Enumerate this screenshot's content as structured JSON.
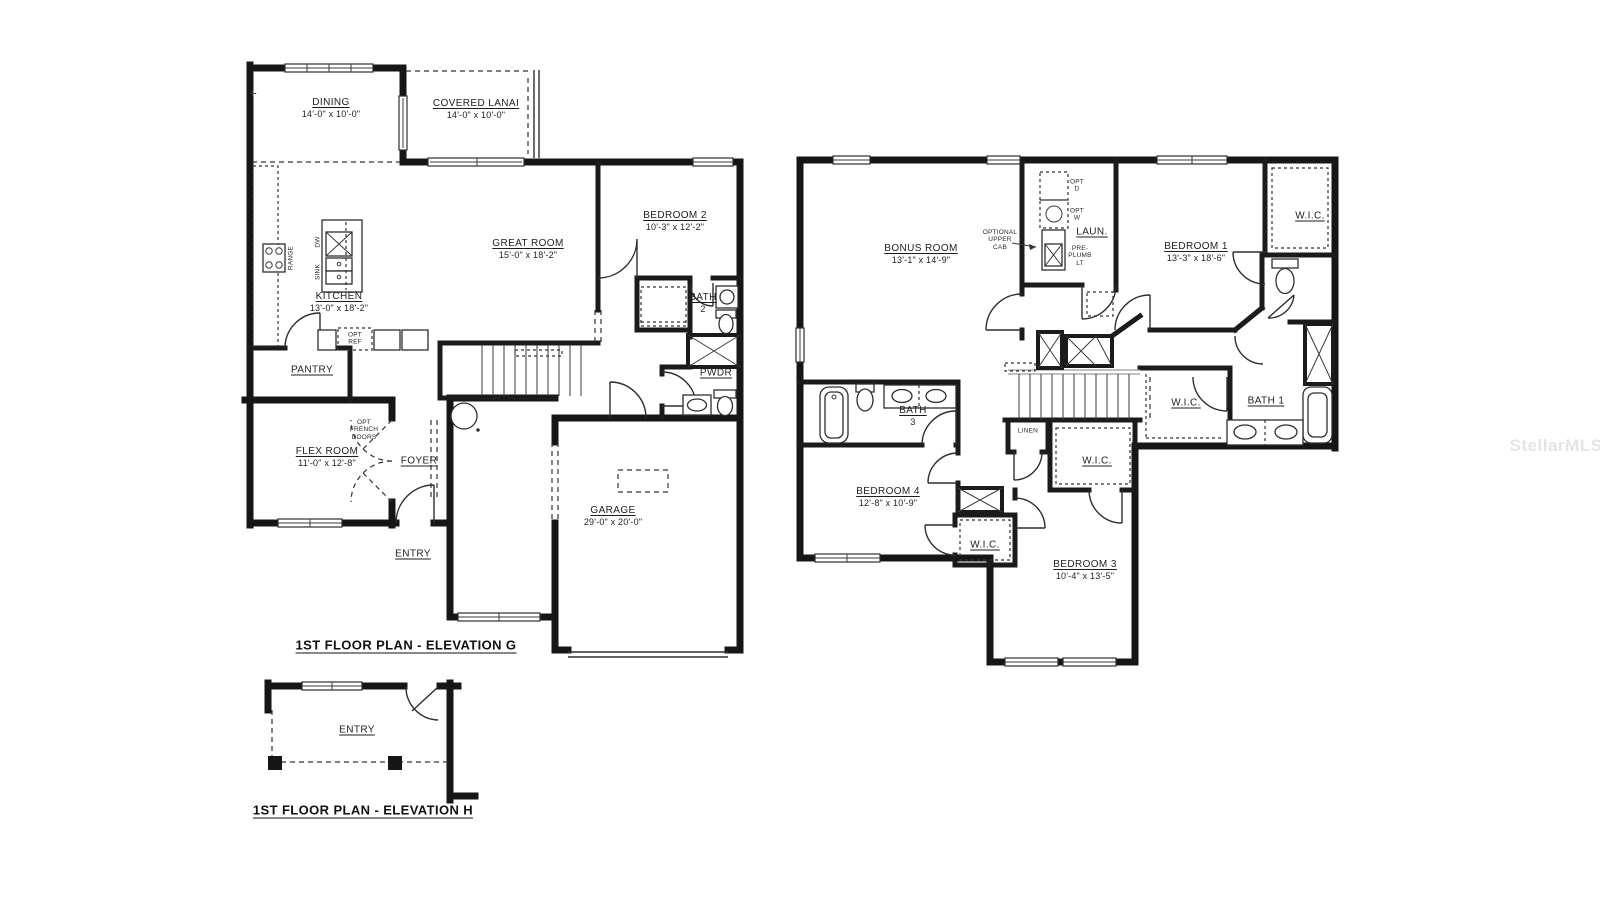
{
  "type": "floor-plan",
  "watermark": "StellarMLS",
  "corner_mark": "+",
  "plans": [
    {
      "name": "first-floor-elevation-g",
      "caption": "1ST FLOOR PLAN - ELEVATION G",
      "rooms": [
        {
          "label": "DINING",
          "dims": "14'-0\" x 10'-0\"",
          "x": 331,
          "y": 108
        },
        {
          "label": "COVERED LANAI",
          "dims": "14'-0\" x 10'-0\"",
          "x": 476,
          "y": 109
        },
        {
          "label": "GREAT ROOM",
          "dims": "15'-0\" x 18'-2\"",
          "x": 528,
          "y": 249
        },
        {
          "label": "BEDROOM 2",
          "dims": "10'-3\" x 12'-2\"",
          "x": 675,
          "y": 221
        },
        {
          "label": "KITCHEN",
          "dims": "13'-0\" x 18'-2\"",
          "x": 339,
          "y": 302
        },
        {
          "label": "BATH",
          "dims": "2",
          "x": 703,
          "y": 303
        },
        {
          "label": "PANTRY",
          "x": 312,
          "y": 370
        },
        {
          "label": "PWDR",
          "x": 716,
          "y": 373
        },
        {
          "label": "FLEX ROOM",
          "dims": "11'-0\" x 12'-8\"",
          "x": 327,
          "y": 457
        },
        {
          "label": "FOYER",
          "x": 419,
          "y": 461
        },
        {
          "label": "ENTRY",
          "x": 413,
          "y": 554
        },
        {
          "label": "GARAGE",
          "dims": "29'-0\" x 20'-0\"",
          "x": 613,
          "y": 516
        }
      ],
      "annotations": [
        {
          "text": "OPT\nFRENCH\nDOORS",
          "x": 364,
          "y": 430
        },
        {
          "text": "OPT\nREF",
          "x": 355,
          "y": 339
        },
        {
          "text": "RANGE",
          "x": 291,
          "y": 258,
          "rotate": -90
        },
        {
          "text": "DW",
          "x": 318,
          "y": 242,
          "rotate": -90
        },
        {
          "text": "SINK",
          "x": 318,
          "y": 272,
          "rotate": -90
        }
      ]
    },
    {
      "name": "second-floor",
      "caption": "",
      "rooms": [
        {
          "label": "BONUS ROOM",
          "dims": "13'-1\" x 14'-9\"",
          "x": 921,
          "y": 254
        },
        {
          "label": "LAUN.",
          "x": 1092,
          "y": 232
        },
        {
          "label": "BEDROOM 1",
          "dims": "13'-3\" x 18'-6\"",
          "x": 1196,
          "y": 252
        },
        {
          "label": "W.I.C.",
          "x": 1310,
          "y": 216
        },
        {
          "label": "BATH 1",
          "x": 1266,
          "y": 401
        },
        {
          "label": "W.I.C.",
          "x": 1186,
          "y": 403
        },
        {
          "label": "BATH",
          "dims": "3",
          "x": 913,
          "y": 416
        },
        {
          "label": "BEDROOM 4",
          "dims": "12'-8\" x 10'-9\"",
          "x": 888,
          "y": 497
        },
        {
          "label": "W.I.C.",
          "x": 985,
          "y": 545
        },
        {
          "label": "W.I.C.",
          "x": 1097,
          "y": 461
        },
        {
          "label": "BEDROOM 3",
          "dims": "10'-4\" x 13'-5\"",
          "x": 1085,
          "y": 570
        }
      ],
      "annotations": [
        {
          "text": "OPT\nD",
          "x": 1077,
          "y": 186
        },
        {
          "text": "OPT\nW",
          "x": 1077,
          "y": 215
        },
        {
          "text": "OPTIONAL\nUPPER\nCAB",
          "x": 1000,
          "y": 240
        },
        {
          "text": "PRE-\nPLUMB\nLT",
          "x": 1080,
          "y": 256
        },
        {
          "text": "LINEN",
          "x": 1028,
          "y": 431
        }
      ]
    },
    {
      "name": "first-floor-elevation-h",
      "caption": "1ST FLOOR PLAN - ELEVATION H",
      "rooms": [
        {
          "label": "ENTRY",
          "x": 357,
          "y": 730
        }
      ],
      "annotations": []
    }
  ]
}
